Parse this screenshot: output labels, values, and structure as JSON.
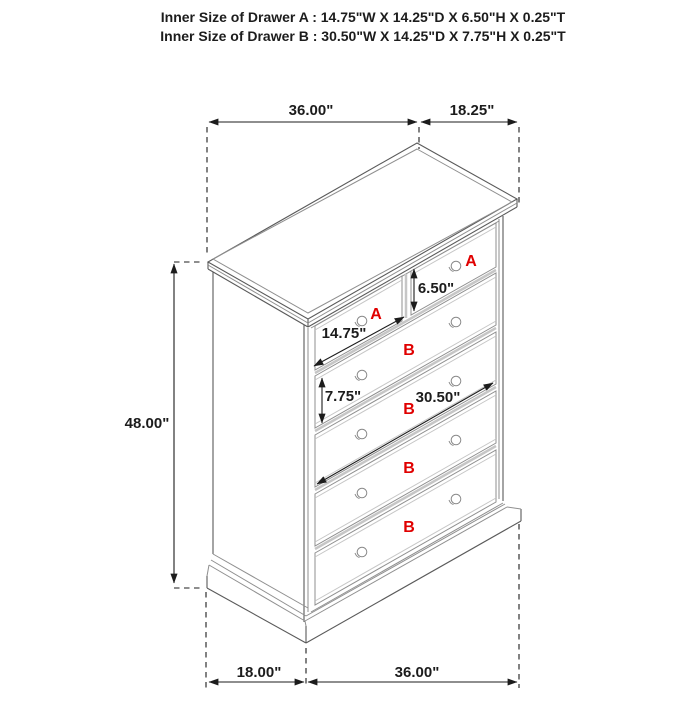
{
  "header": {
    "line1": "Inner Size of Drawer A : 14.75\"W X 14.25\"D X 6.50\"H X 0.25\"T",
    "line2": "Inner Size of Drawer B : 30.50\"W X 14.25\"D X 7.75\"H X 0.25\"T"
  },
  "dimensions": {
    "top_width": "36.00\"",
    "top_depth": "18.25\"",
    "height": "48.00\"",
    "bottom_depth": "18.00\"",
    "bottom_width": "36.00\"",
    "drawer_a_width": "14.75\"",
    "drawer_a_height": "6.50\"",
    "drawer_b_height": "7.75\"",
    "drawer_b_width": "30.50\""
  },
  "drawer_labels": {
    "a": "A",
    "b": "B"
  },
  "colors": {
    "label_red": "#e00000",
    "dimension_black": "#1c1c1c",
    "outline_gray": "#5a5a5a",
    "detail_gray": "#8f8f8f"
  }
}
